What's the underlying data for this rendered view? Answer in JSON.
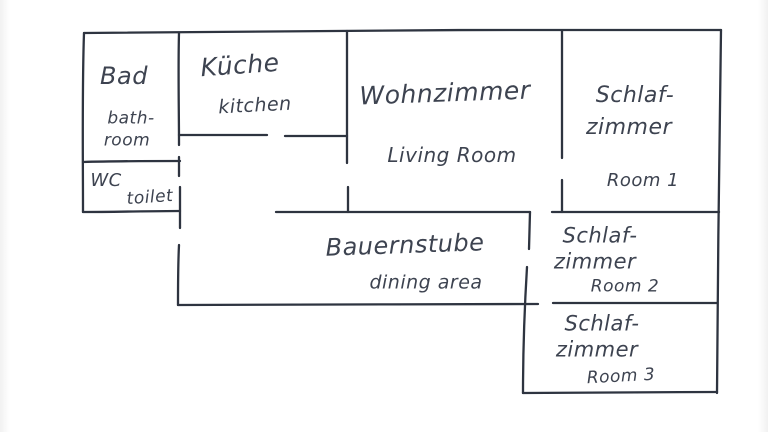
{
  "meta": {
    "type": "hand-drawn apartment floor plan",
    "language": "German with English translations"
  },
  "colors": {
    "background": "#ffffff",
    "wall_line": "#2e3440",
    "handwriting_ink": "#3d4350"
  },
  "rooms": {
    "bad": {
      "de": "Bad",
      "en_line1": "bath-",
      "en_line2": "room"
    },
    "kueche": {
      "de": "Küche",
      "en": "kitchen"
    },
    "wohnzimmer": {
      "de": "Wohnzimmer",
      "en": "Living Room"
    },
    "schlafzimmer1": {
      "de_line1": "Schlaf-",
      "de_line2": "zimmer",
      "en": "Room 1"
    },
    "wc": {
      "de": "WC",
      "en": "toilet"
    },
    "bauernstube": {
      "de": "Bauernstube",
      "en": "dining area"
    },
    "schlafzimmer2": {
      "de_line1": "Schlaf-",
      "de_line2": "zimmer",
      "en": "Room 2"
    },
    "schlafzimmer3": {
      "de_line1": "Schlaf-",
      "de_line2": "zimmer",
      "en": "Room 3"
    }
  }
}
